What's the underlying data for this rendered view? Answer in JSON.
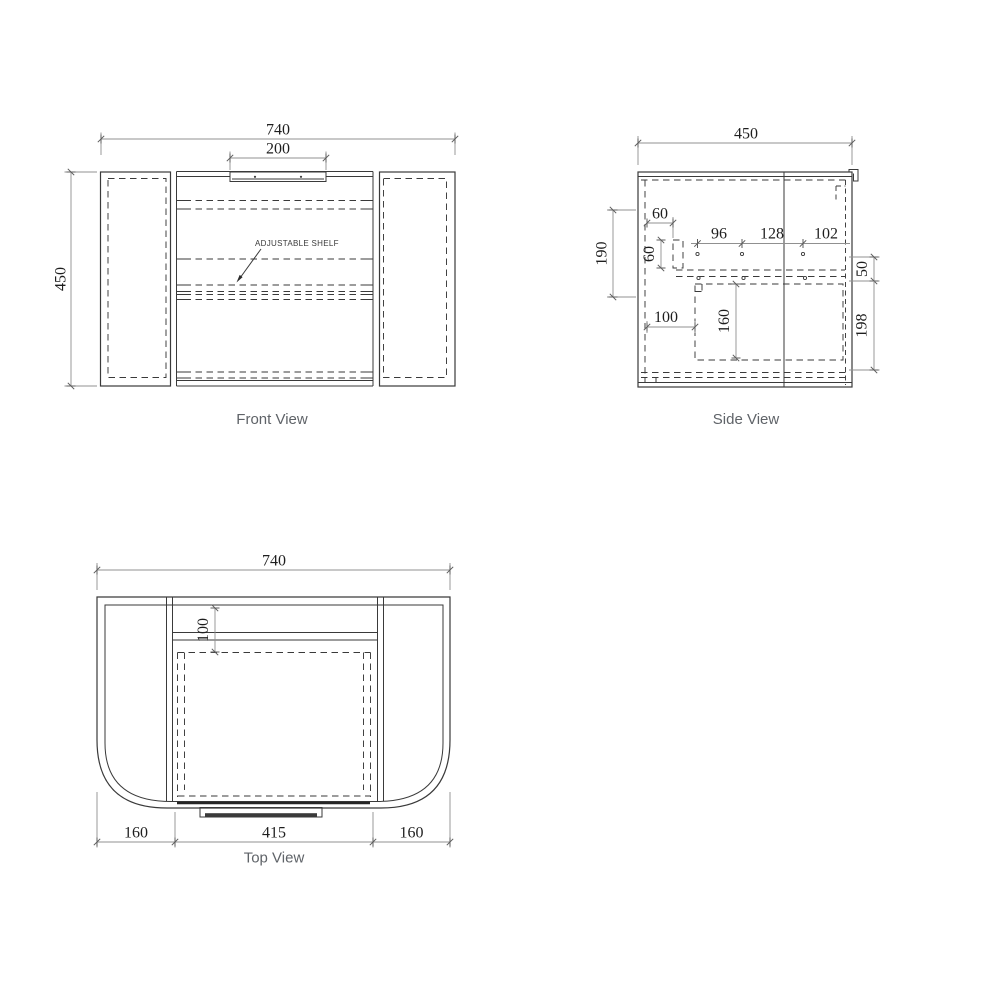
{
  "colors": {
    "object_line": "#3a3a3a",
    "dimension_line": "#909090",
    "dimension_text": "#1e1e1e",
    "caption_text": "#5f6368",
    "background": "#ffffff"
  },
  "views": {
    "front": {
      "caption": "Front View",
      "note": "ADJUSTABLE SHELF",
      "dims": {
        "overall_width": "740",
        "handle_width": "200",
        "overall_height": "450"
      }
    },
    "side": {
      "caption": "Side View",
      "dims": {
        "overall_depth": "450",
        "left_height": "190",
        "bracket_offset": "60",
        "bracket_height": "60",
        "hole_pitch_1": "96",
        "hole_pitch_2": "128",
        "hole_pitch_3": "102",
        "drawer_inset": "100",
        "drawer_height": "160",
        "front_gap": "50",
        "lower_height": "198"
      }
    },
    "top": {
      "caption": "Top View",
      "dims": {
        "overall_width": "740",
        "back_depth": "100",
        "left_wing": "160",
        "center_width": "415",
        "right_wing": "160"
      }
    }
  }
}
